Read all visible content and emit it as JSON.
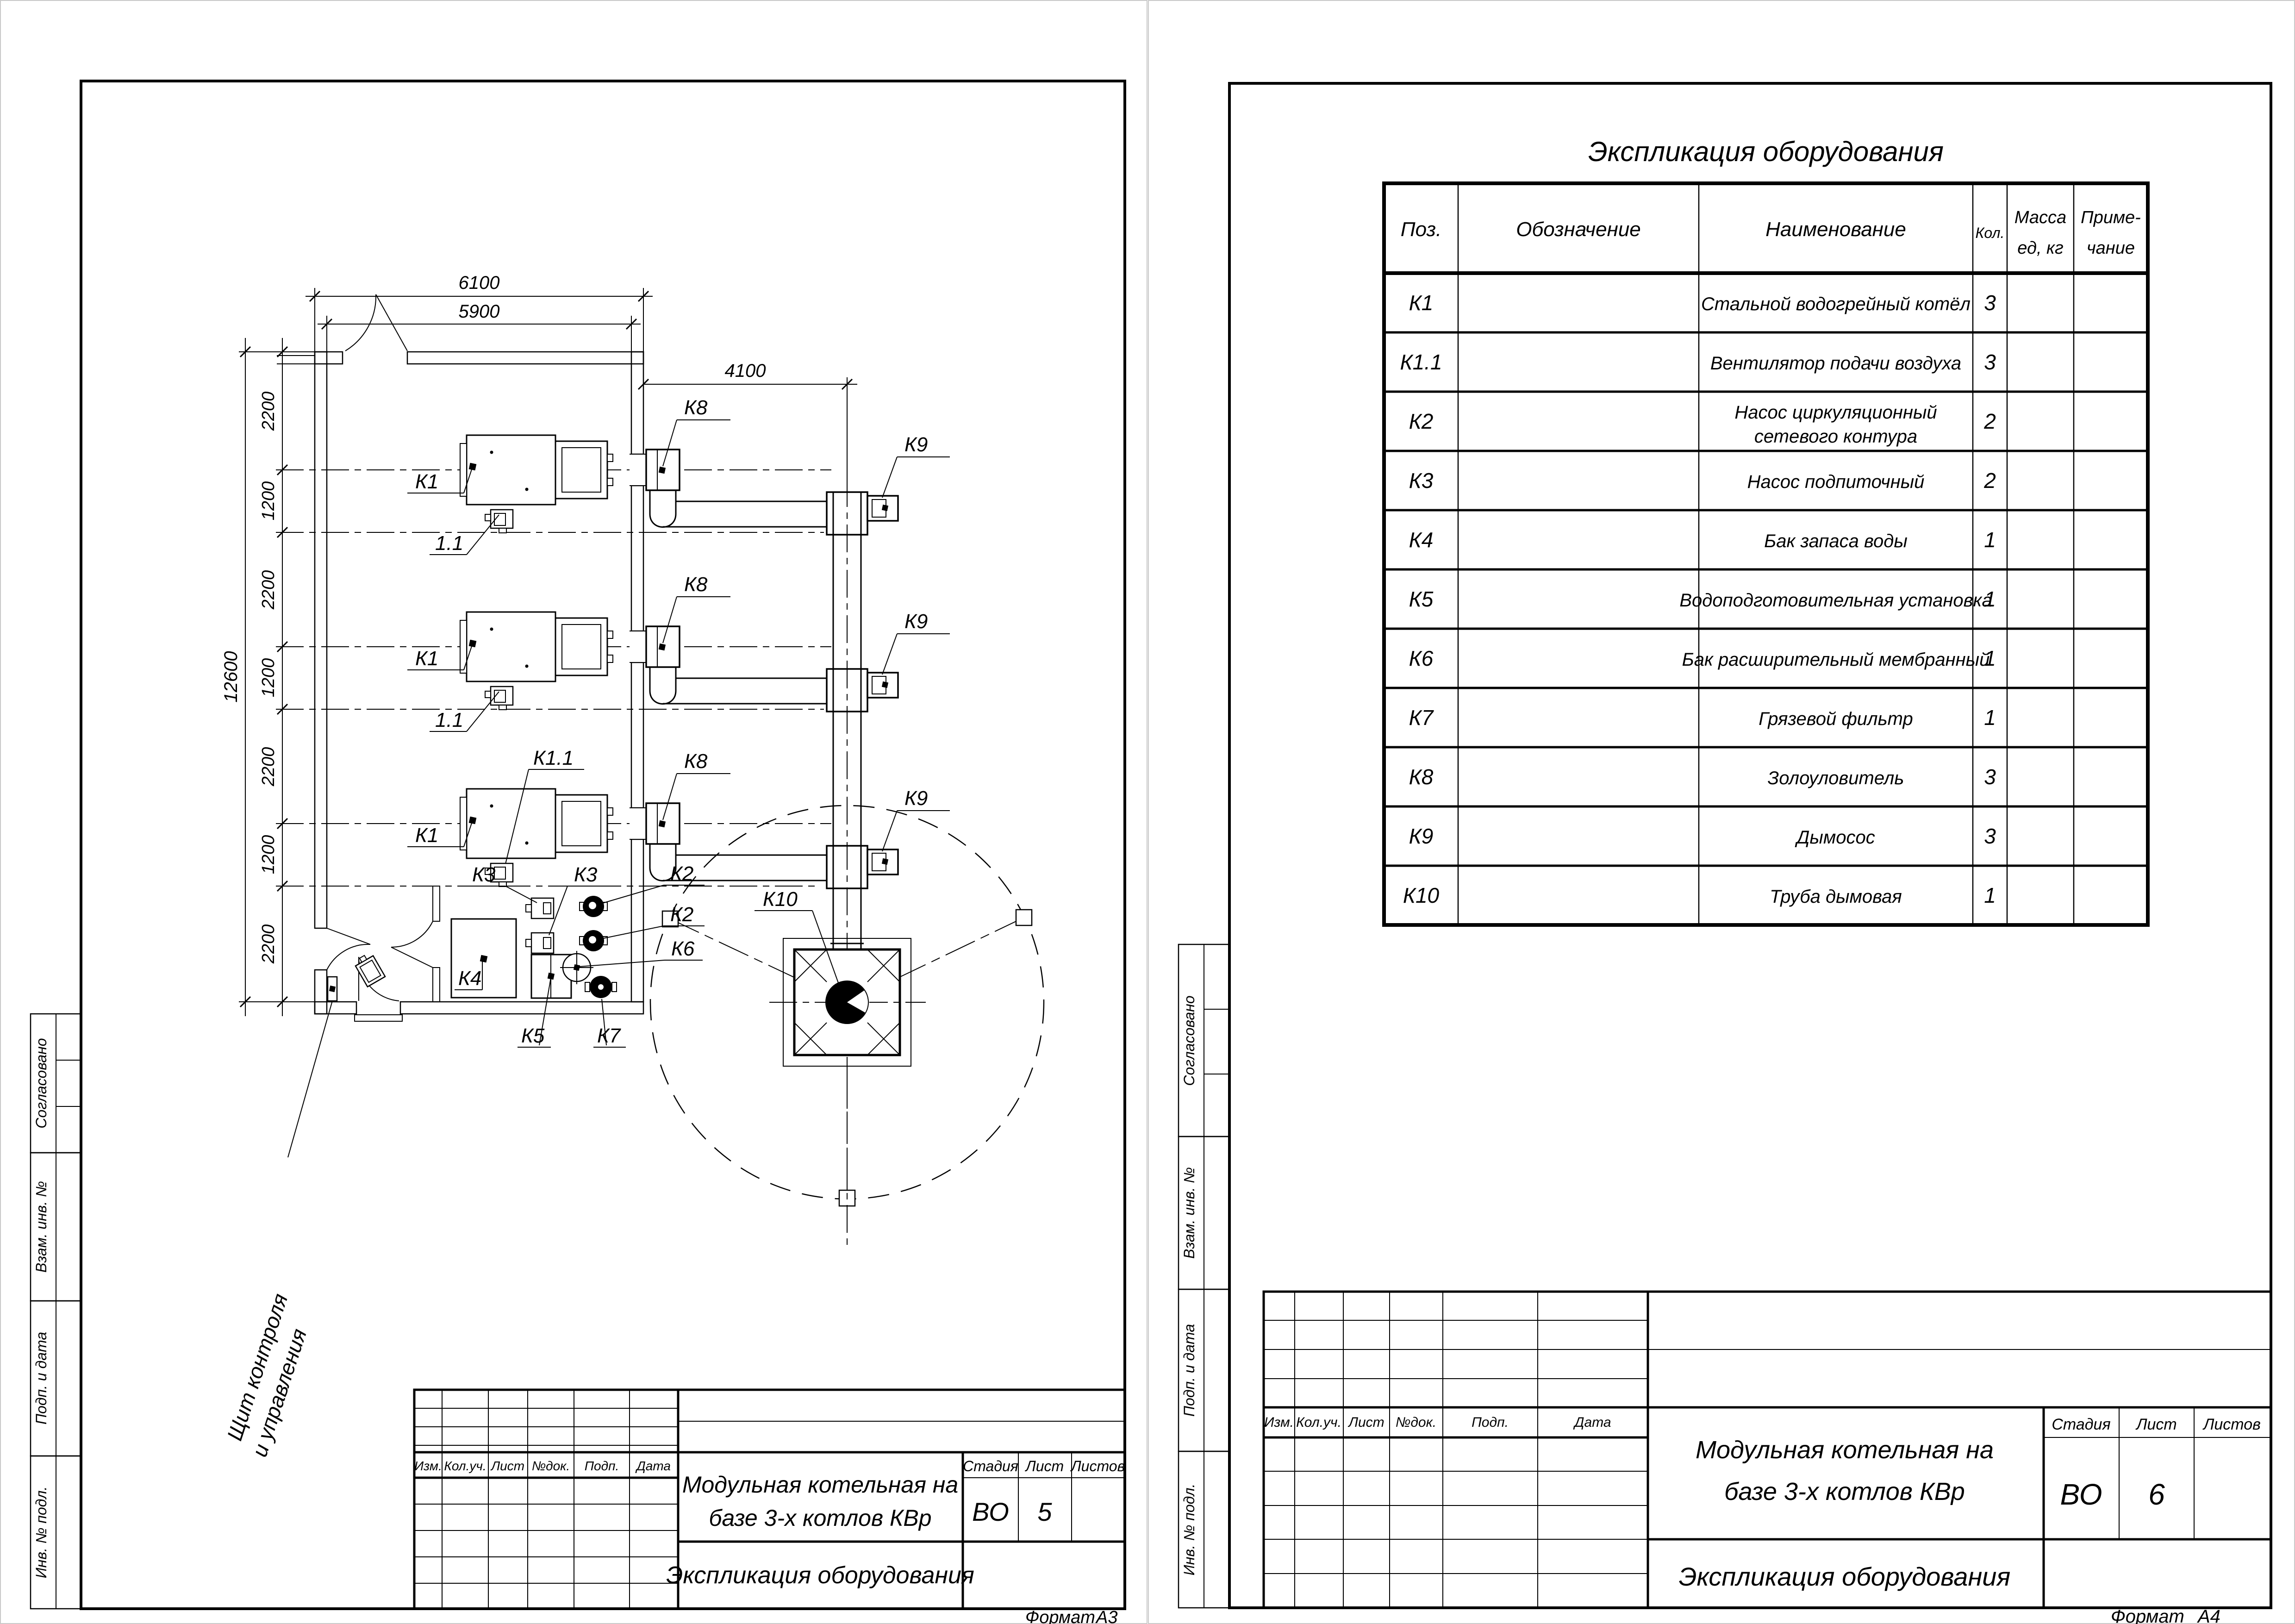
{
  "left_sheet": {
    "format_label": "Формат",
    "format_value": "А3",
    "stamps": [
      "Согласовано",
      "Взам. инв. №",
      "Подп. и дата",
      "Инв. № подл."
    ],
    "titleblock": {
      "rev_cols": [
        "Изм.",
        "Кол.уч.",
        "Лист",
        "№док.",
        "Подп.",
        "Дата"
      ],
      "stage_label": "Стадия",
      "sheet_label": "Лист",
      "sheets_label": "Листов",
      "stage": "ВО",
      "sheet": "5",
      "title_line1": "Модульная котельная на",
      "title_line2": "базе 3-х котлов КВр",
      "doc_name": "Экспликация оборудования"
    },
    "plan": {
      "dims": {
        "outer_width": "6100",
        "inner_width": "5900",
        "right_offset": "4100",
        "total_height": "12600",
        "chain": [
          "2200",
          "1200",
          "2200",
          "1200",
          "2200",
          "1200",
          "2200"
        ]
      },
      "labels": {
        "k1": "К1",
        "k1_fan": "1.1",
        "k11": "К1.1",
        "k2": "К2",
        "k3": "К3",
        "k4": "К4",
        "k5": "К5",
        "k6": "К6",
        "k7": "К7",
        "k8": "К8",
        "k9": "К9",
        "k10": "К10"
      },
      "note_line1": "Щит контроля",
      "note_line2": "и управления"
    }
  },
  "right_sheet": {
    "format_label": "Формат",
    "format_value": "А4",
    "stamps": [
      "Согласовано",
      "Взам. инв. №",
      "Подп. и дата",
      "Инв. № подл."
    ],
    "titleblock": {
      "rev_cols": [
        "Изм.",
        "Кол.уч.",
        "Лист",
        "№док.",
        "Подп.",
        "Дата"
      ],
      "stage_label": "Стадия",
      "sheet_label": "Лист",
      "sheets_label": "Листов",
      "stage": "ВО",
      "sheet": "6",
      "title_line1": "Модульная котельная на",
      "title_line2": "базе 3-х котлов КВр",
      "doc_name": "Экспликация оборудования"
    },
    "spec": {
      "title": "Экспликация оборудования",
      "headers": {
        "pos": "Поз.",
        "designation": "Обозначение",
        "name": "Наименование",
        "qty": "Кол.",
        "mass1": "Масса",
        "mass2": "ед, кг",
        "note1": "Приме-",
        "note2": "чание"
      },
      "rows": [
        {
          "pos": "К1",
          "name1": "Стальной водогрейный котёл",
          "name2": "",
          "qty": "3"
        },
        {
          "pos": "К1.1",
          "name1": "Вентилятор подачи воздуха",
          "name2": "",
          "qty": "3"
        },
        {
          "pos": "К2",
          "name1": "Насос циркуляционный",
          "name2": "сетевого контура",
          "qty": "2"
        },
        {
          "pos": "К3",
          "name1": "Насос подпиточный",
          "name2": "",
          "qty": "2"
        },
        {
          "pos": "К4",
          "name1": "Бак запаса воды",
          "name2": "",
          "qty": "1"
        },
        {
          "pos": "К5",
          "name1": "Водоподготовительная установка",
          "name2": "",
          "qty": "1"
        },
        {
          "pos": "К6",
          "name1": "Бак расширительный мембранный",
          "name2": "",
          "qty": "1"
        },
        {
          "pos": "К7",
          "name1": "Грязевой фильтр",
          "name2": "",
          "qty": "1"
        },
        {
          "pos": "К8",
          "name1": "Золоуловитель",
          "name2": "",
          "qty": "3"
        },
        {
          "pos": "К9",
          "name1": "Дымосос",
          "name2": "",
          "qty": "3"
        },
        {
          "pos": "К10",
          "name1": "Труба дымовая",
          "name2": "",
          "qty": "1"
        }
      ]
    }
  }
}
